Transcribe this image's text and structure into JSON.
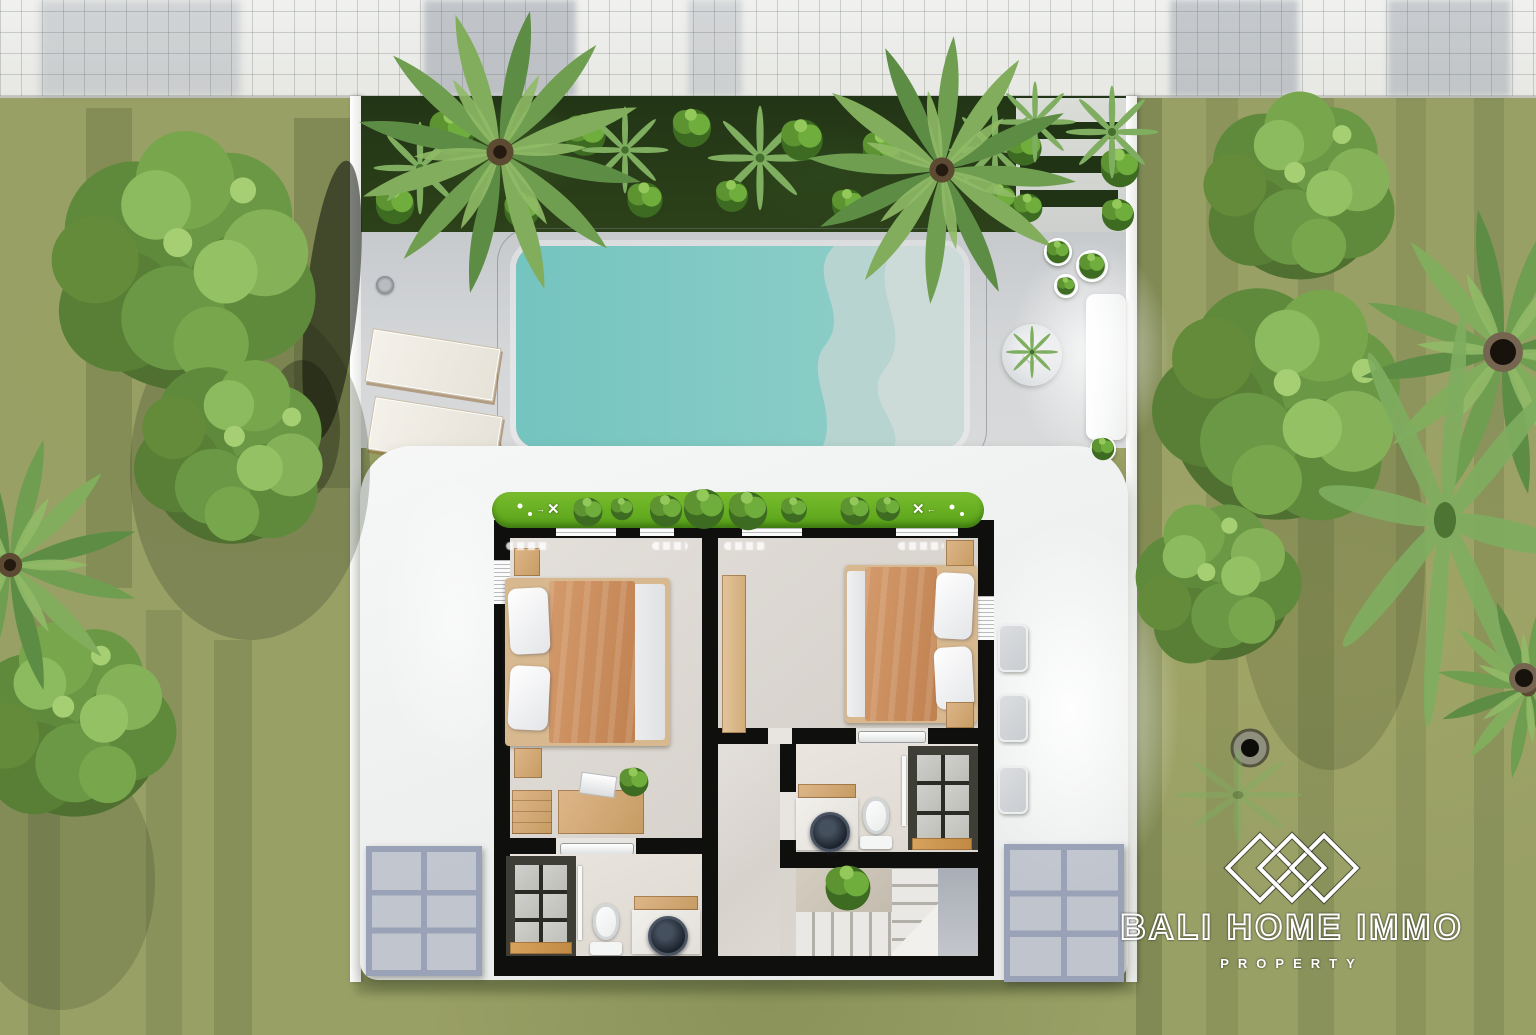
{
  "watermark": {
    "brand": "BALI HOME IMMO",
    "tagline": "PROPERTY",
    "logo_icon": "three-diamonds"
  },
  "icons": {
    "ceiling_fan_glyph": "✕",
    "fan_arrow_left": "←",
    "fan_arrow_right": "→"
  },
  "palette": {
    "grass": "#99a066",
    "grass_shadow": "#4c5830",
    "sidewalk": "#ebecea",
    "garden_soil": "#26381a",
    "planter_green": "#6ab324",
    "foliage_dark": "#3c6b21",
    "foliage_light": "#8ec455",
    "deck": "#cfd2d5",
    "pool_teal": "#7cc8c3",
    "pool_shallow_1": "#b7d4d0",
    "pool_shallow_2": "#ccdbd8",
    "building_white": "#f6f7f7",
    "wall_black": "#0f0f0d",
    "interior_floor": "#dcd8d3",
    "wood": "#d9b184",
    "bed_blanket": "#c98e5e",
    "linen_white": "#f1f2f3",
    "shower_tile": "#c8c8c4",
    "mosaic_border": "#3e3e37",
    "sink_black": "#1d242e",
    "trellis_gray": "#99a2b6"
  },
  "scene": {
    "type": "3d-rendered villa floor plan, top view",
    "objects": [
      "sidewalk",
      "boundary-wall",
      "tropical-garden",
      "palm-tree",
      "tree",
      "stepping-stones",
      "swimming-pool",
      "beach-entry-waves",
      "sun-lounger",
      "outdoor-shower",
      "potted-plant",
      "round-mat",
      "bench",
      "planter-strip",
      "ceiling-fan",
      "bedroom-bed",
      "nightstand",
      "wardrobe",
      "desk",
      "laptop",
      "toilet",
      "shower",
      "black-basin",
      "vanity",
      "staircase",
      "stair-plant",
      "pergola-trellis",
      "outdoor-chair",
      "palm-trunk-top"
    ]
  }
}
